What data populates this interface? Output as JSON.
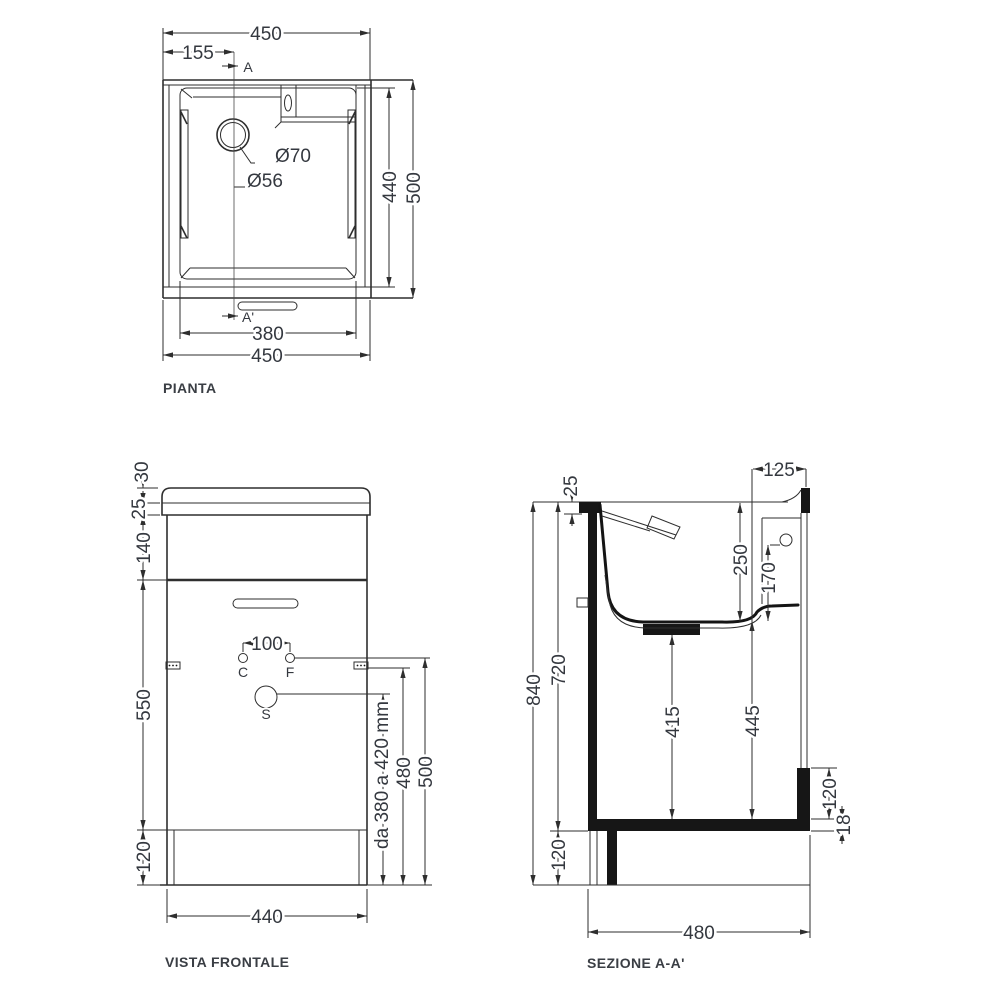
{
  "colors": {
    "line": "#2e2e2e",
    "text": "#34383f",
    "fill": "#161616",
    "background": "#ffffff"
  },
  "views": {
    "plan": {
      "title": "PIANTA",
      "labels": {
        "overall_width_top": "450",
        "drain_offset": "155",
        "section_marker_start": "A",
        "section_marker_end": "A'",
        "drain_outer_diameter": "Ø70",
        "drain_hole_diameter": "Ø56",
        "inner_depth": "440",
        "overall_depth": "500",
        "inner_width": "380",
        "overall_width_bottom": "450"
      }
    },
    "front": {
      "title": "VISTA FRONTALE",
      "labels": {
        "splash_height": "30",
        "top_thickness": "25",
        "apron_height": "140",
        "door_height": "550",
        "plinth_height": "120",
        "tap_centres": "100",
        "hot_tap": "C",
        "cold_tap": "F",
        "siphon": "S",
        "siphon_height_range": "da 380 a 420 mm",
        "bracket_height": "480",
        "tap_height": "500",
        "cabinet_width": "440"
      }
    },
    "section": {
      "title": "SEZIONE A-A'",
      "labels": {
        "deck_depth": "125",
        "top_thickness": "25",
        "basin_depth": "250",
        "overflow_height": "170",
        "overall_height": "840",
        "worktop_underside": "720",
        "drain_to_shelf": "415",
        "basin_to_shelf": "445",
        "rear_step_height": "120",
        "shelf_thickness": "18",
        "plinth_height": "120",
        "overall_depth": "480"
      }
    }
  }
}
